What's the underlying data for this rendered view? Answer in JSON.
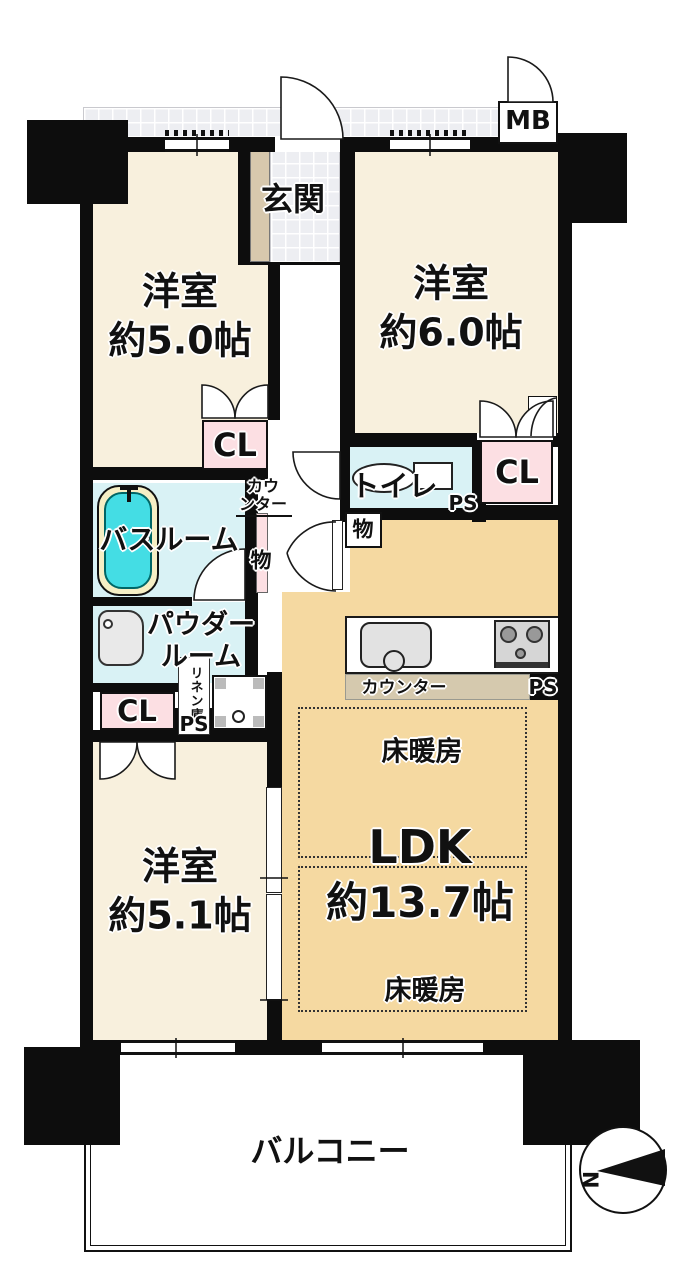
{
  "plan": {
    "meter_box": "MB",
    "entrance": "玄関",
    "bedroom_top_left": {
      "name": "洋室",
      "size": "約5.0帖"
    },
    "bedroom_top_right": {
      "name": "洋室",
      "size": "約6.0帖"
    },
    "bedroom_bottom_left": {
      "name": "洋室",
      "size": "約5.1帖"
    },
    "ldk": {
      "name": "LDK",
      "size": "約13.7帖"
    },
    "closet_top_left": "CL",
    "closet_top_right": "CL",
    "closet_bottom_left": "CL",
    "toilet": "トイレ",
    "bathroom": "バスルーム",
    "powder_room": {
      "line1": "パウダー",
      "line2": "ルーム"
    },
    "linen_closet": "リネン庫",
    "hall_counter": {
      "line1": "カウ",
      "line2": "ンター"
    },
    "kitchen_counter": "カウンター",
    "storage_hall": "物",
    "storage_toilet": "物",
    "ps_toilet": "PS",
    "ps_kitchen": "PS",
    "ps_linen": "PS",
    "floor_heating_top": "床暖房",
    "floor_heating_bottom": "床暖房",
    "balcony": "バルコニー",
    "compass_north": "N"
  },
  "colors": {
    "wall": "#0d0d0d",
    "room_floor": "#f8f0dd",
    "ldk_floor": "#f5d9a1",
    "closet_pink": "#fcdfe3",
    "wet_area_cyan": "#d9f2f5",
    "bathtub": "#44dde4",
    "tile_gray": "#edeef2",
    "cabinet_tan": "#d7c8ad",
    "counter_tan": "#d5c9ae"
  }
}
